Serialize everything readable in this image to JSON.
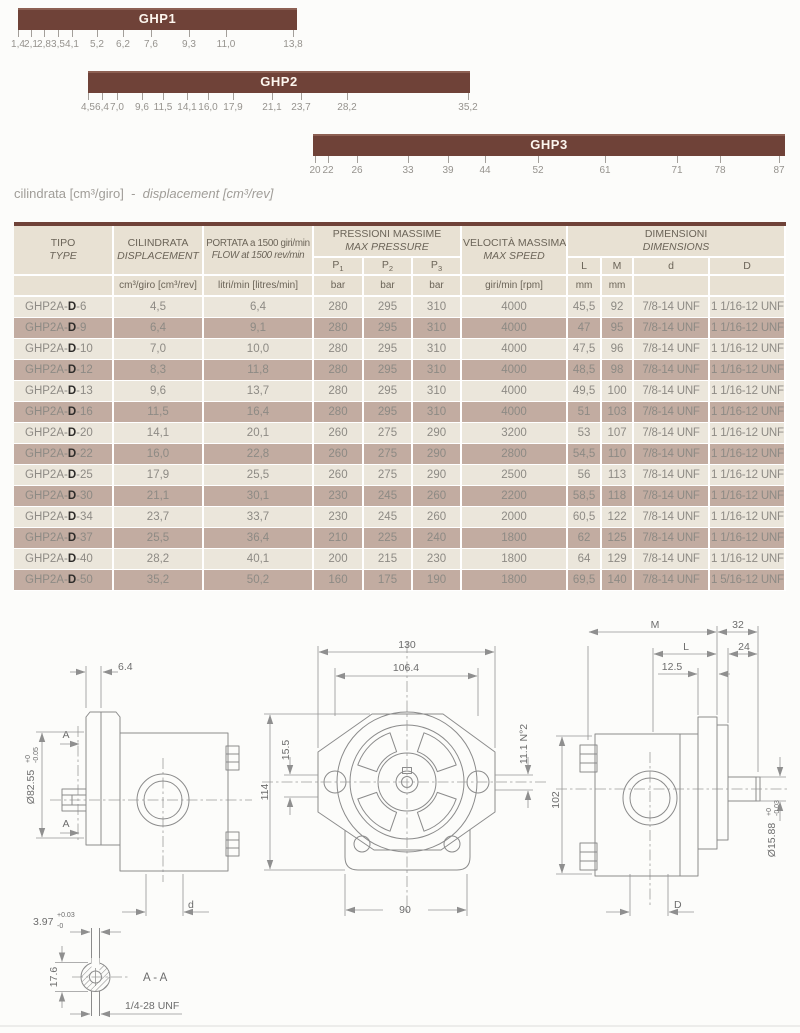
{
  "caption": {
    "it": "cilindrata [cm³/giro]",
    "sep": "-",
    "en": "displacement [cm³/rev]"
  },
  "range_bars": [
    {
      "name": "GHP1",
      "label": "GHP1",
      "bar_left": 18,
      "bar_top": 8,
      "bar_width": 279,
      "ticks": [
        {
          "t": "1,4",
          "x": 18
        },
        {
          "t": "2,1",
          "x": 31
        },
        {
          "t": "2,8",
          "x": 44
        },
        {
          "t": "3,5",
          "x": 58
        },
        {
          "t": "4,1",
          "x": 72
        },
        {
          "t": "5,2",
          "x": 97
        },
        {
          "t": "6,2",
          "x": 123
        },
        {
          "t": "7,6",
          "x": 151
        },
        {
          "t": "9,3",
          "x": 189
        },
        {
          "t": "11,0",
          "x": 226
        },
        {
          "t": "13,8",
          "x": 293
        }
      ]
    },
    {
      "name": "GHP2",
      "label": "GHP2",
      "bar_left": 88,
      "bar_top": 71,
      "bar_width": 382,
      "ticks": [
        {
          "t": "4,5",
          "x": 88
        },
        {
          "t": "6,4",
          "x": 102
        },
        {
          "t": "7,0",
          "x": 117
        },
        {
          "t": "9,6",
          "x": 142
        },
        {
          "t": "11,5",
          "x": 163
        },
        {
          "t": "14,1",
          "x": 187
        },
        {
          "t": "16,0",
          "x": 208
        },
        {
          "t": "17,9",
          "x": 233
        },
        {
          "t": "21,1",
          "x": 272
        },
        {
          "t": "23,7",
          "x": 301
        },
        {
          "t": "28,2",
          "x": 347
        },
        {
          "t": "35,2",
          "x": 468
        }
      ]
    },
    {
      "name": "GHP3",
      "label": "GHP3",
      "bar_left": 313,
      "bar_top": 134,
      "bar_width": 472,
      "ticks": [
        {
          "t": "20",
          "x": 315
        },
        {
          "t": "22",
          "x": 328
        },
        {
          "t": "26",
          "x": 357
        },
        {
          "t": "33",
          "x": 408
        },
        {
          "t": "39",
          "x": 448
        },
        {
          "t": "44",
          "x": 485
        },
        {
          "t": "52",
          "x": 538
        },
        {
          "t": "61",
          "x": 605
        },
        {
          "t": "71",
          "x": 677
        },
        {
          "t": "78",
          "x": 720
        },
        {
          "t": "87",
          "x": 779
        }
      ]
    }
  ],
  "table": {
    "headers": {
      "tipo_it": "TIPO",
      "tipo_en": "TYPE",
      "cil_it": "CILINDRATA",
      "cil_en": "DISPLACEMENT",
      "portata_it": "PORTATA a 1500 giri/min",
      "portata_en": "FLOW at 1500 rev/min",
      "press_it": "PRESSIONI MASSIME",
      "press_en": "MAX PRESSURE",
      "vel_it": "VELOCITÀ MASSIMA",
      "vel_en": "MAX SPEED",
      "dim_it": "DIMENSIONI",
      "dim_en": "DIMENSIONS"
    },
    "sub_headers": {
      "p1": {
        "base": "P",
        "sub": "1"
      },
      "p2": {
        "base": "P",
        "sub": "2"
      },
      "p3": {
        "base": "P",
        "sub": "3"
      },
      "L": "L",
      "M": "M",
      "d": "d",
      "D": "D"
    },
    "units": {
      "cil": "cm³/giro [cm³/rev]",
      "flow": "litri/min [litres/min]",
      "bar": "bar",
      "speed": "giri/min [rpm]",
      "mm": "mm"
    },
    "rows": [
      {
        "type_prefix": "GHP2A-",
        "type_bold": "D",
        "type_suffix": "-6",
        "disp": "4,5",
        "flow": "6,4",
        "p1": "280",
        "p2": "295",
        "p3": "310",
        "speed": "4000",
        "L": "45,5",
        "M": "92",
        "d": "7/8-14 UNF",
        "D": "1 1/16-12 UNF"
      },
      {
        "type_prefix": "GHP2A-",
        "type_bold": "D",
        "type_suffix": "-9",
        "disp": "6,4",
        "flow": "9,1",
        "p1": "280",
        "p2": "295",
        "p3": "310",
        "speed": "4000",
        "L": "47",
        "M": "95",
        "d": "7/8-14 UNF",
        "D": "1 1/16-12 UNF"
      },
      {
        "type_prefix": "GHP2A-",
        "type_bold": "D",
        "type_suffix": "-10",
        "disp": "7,0",
        "flow": "10,0",
        "p1": "280",
        "p2": "295",
        "p3": "310",
        "speed": "4000",
        "L": "47,5",
        "M": "96",
        "d": "7/8-14 UNF",
        "D": "1 1/16-12 UNF"
      },
      {
        "type_prefix": "GHP2A-",
        "type_bold": "D",
        "type_suffix": "-12",
        "disp": "8,3",
        "flow": "11,8",
        "p1": "280",
        "p2": "295",
        "p3": "310",
        "speed": "4000",
        "L": "48,5",
        "M": "98",
        "d": "7/8-14 UNF",
        "D": "1 1/16-12 UNF"
      },
      {
        "type_prefix": "GHP2A-",
        "type_bold": "D",
        "type_suffix": "-13",
        "disp": "9,6",
        "flow": "13,7",
        "p1": "280",
        "p2": "295",
        "p3": "310",
        "speed": "4000",
        "L": "49,5",
        "M": "100",
        "d": "7/8-14 UNF",
        "D": "1 1/16-12 UNF"
      },
      {
        "type_prefix": "GHP2A-",
        "type_bold": "D",
        "type_suffix": "-16",
        "disp": "11,5",
        "flow": "16,4",
        "p1": "280",
        "p2": "295",
        "p3": "310",
        "speed": "4000",
        "L": "51",
        "M": "103",
        "d": "7/8-14 UNF",
        "D": "1 1/16-12 UNF"
      },
      {
        "type_prefix": "GHP2A-",
        "type_bold": "D",
        "type_suffix": "-20",
        "disp": "14,1",
        "flow": "20,1",
        "p1": "260",
        "p2": "275",
        "p3": "290",
        "speed": "3200",
        "L": "53",
        "M": "107",
        "d": "7/8-14 UNF",
        "D": "1 1/16-12 UNF"
      },
      {
        "type_prefix": "GHP2A-",
        "type_bold": "D",
        "type_suffix": "-22",
        "disp": "16,0",
        "flow": "22,8",
        "p1": "260",
        "p2": "275",
        "p3": "290",
        "speed": "2800",
        "L": "54,5",
        "M": "110",
        "d": "7/8-14 UNF",
        "D": "1 1/16-12 UNF"
      },
      {
        "type_prefix": "GHP2A-",
        "type_bold": "D",
        "type_suffix": "-25",
        "disp": "17,9",
        "flow": "25,5",
        "p1": "260",
        "p2": "275",
        "p3": "290",
        "speed": "2500",
        "L": "56",
        "M": "113",
        "d": "7/8-14 UNF",
        "D": "1 1/16-12 UNF"
      },
      {
        "type_prefix": "GHP2A-",
        "type_bold": "D",
        "type_suffix": "-30",
        "disp": "21,1",
        "flow": "30,1",
        "p1": "230",
        "p2": "245",
        "p3": "260",
        "speed": "2200",
        "L": "58,5",
        "M": "118",
        "d": "7/8-14 UNF",
        "D": "1 1/16-12 UNF"
      },
      {
        "type_prefix": "GHP2A-",
        "type_bold": "D",
        "type_suffix": "-34",
        "disp": "23,7",
        "flow": "33,7",
        "p1": "230",
        "p2": "245",
        "p3": "260",
        "speed": "2000",
        "L": "60,5",
        "M": "122",
        "d": "7/8-14 UNF",
        "D": "1 1/16-12 UNF"
      },
      {
        "type_prefix": "GHP2A-",
        "type_bold": "D",
        "type_suffix": "-37",
        "disp": "25,5",
        "flow": "36,4",
        "p1": "210",
        "p2": "225",
        "p3": "240",
        "speed": "1800",
        "L": "62",
        "M": "125",
        "d": "7/8-14 UNF",
        "D": "1 1/16-12 UNF"
      },
      {
        "type_prefix": "GHP2A-",
        "type_bold": "D",
        "type_suffix": "-40",
        "disp": "28,2",
        "flow": "40,1",
        "p1": "200",
        "p2": "215",
        "p3": "230",
        "speed": "1800",
        "L": "64",
        "M": "129",
        "d": "7/8-14 UNF",
        "D": "1 1/16-12 UNF"
      },
      {
        "type_prefix": "GHP2A-",
        "type_bold": "D",
        "type_suffix": "-50",
        "disp": "35,2",
        "flow": "50,2",
        "p1": "160",
        "p2": "175",
        "p3": "190",
        "speed": "1800",
        "L": "69,5",
        "M": "140",
        "d": "7/8-14 UNF",
        "D": "1 5/16-12 UNF"
      }
    ]
  },
  "drawings": {
    "left_view": {
      "dim_thickness": "6.4",
      "dia_label": "Ø82.55",
      "dia_tol_up": "+0",
      "dia_tol_dn": "-0.05",
      "section_top": "A",
      "section_bottom": "A",
      "dim_d": "d"
    },
    "front_view": {
      "dim_width": "130",
      "dim_bolt_span": "106.4",
      "dim_offset": "15.5",
      "dim_height": "114",
      "dim_holes": "11.1 N°2",
      "dim_bottom": "90"
    },
    "right_view": {
      "dim_M": "M",
      "dim_32": "32",
      "dim_L": "L",
      "dim_24": "24",
      "dim_12_5": "12.5",
      "dim_102": "102",
      "dia_label": "Ø15.88",
      "dia_tol_up": "+0",
      "dia_tol_dn": "-0.03",
      "dim_D": "D"
    },
    "section": {
      "dim_width": "3.97",
      "tol_up": "+0.03",
      "tol_dn": "-0",
      "dim_height": "17.6",
      "label": "A - A",
      "thread": "1/4-28 UNF"
    }
  },
  "colors": {
    "bar_brown": "#6f4238",
    "unit_row_brown": "#765043",
    "row_mauve": "#c2aca1",
    "row_cream": "#ebe6db",
    "header_cream": "#e8e1d3"
  }
}
